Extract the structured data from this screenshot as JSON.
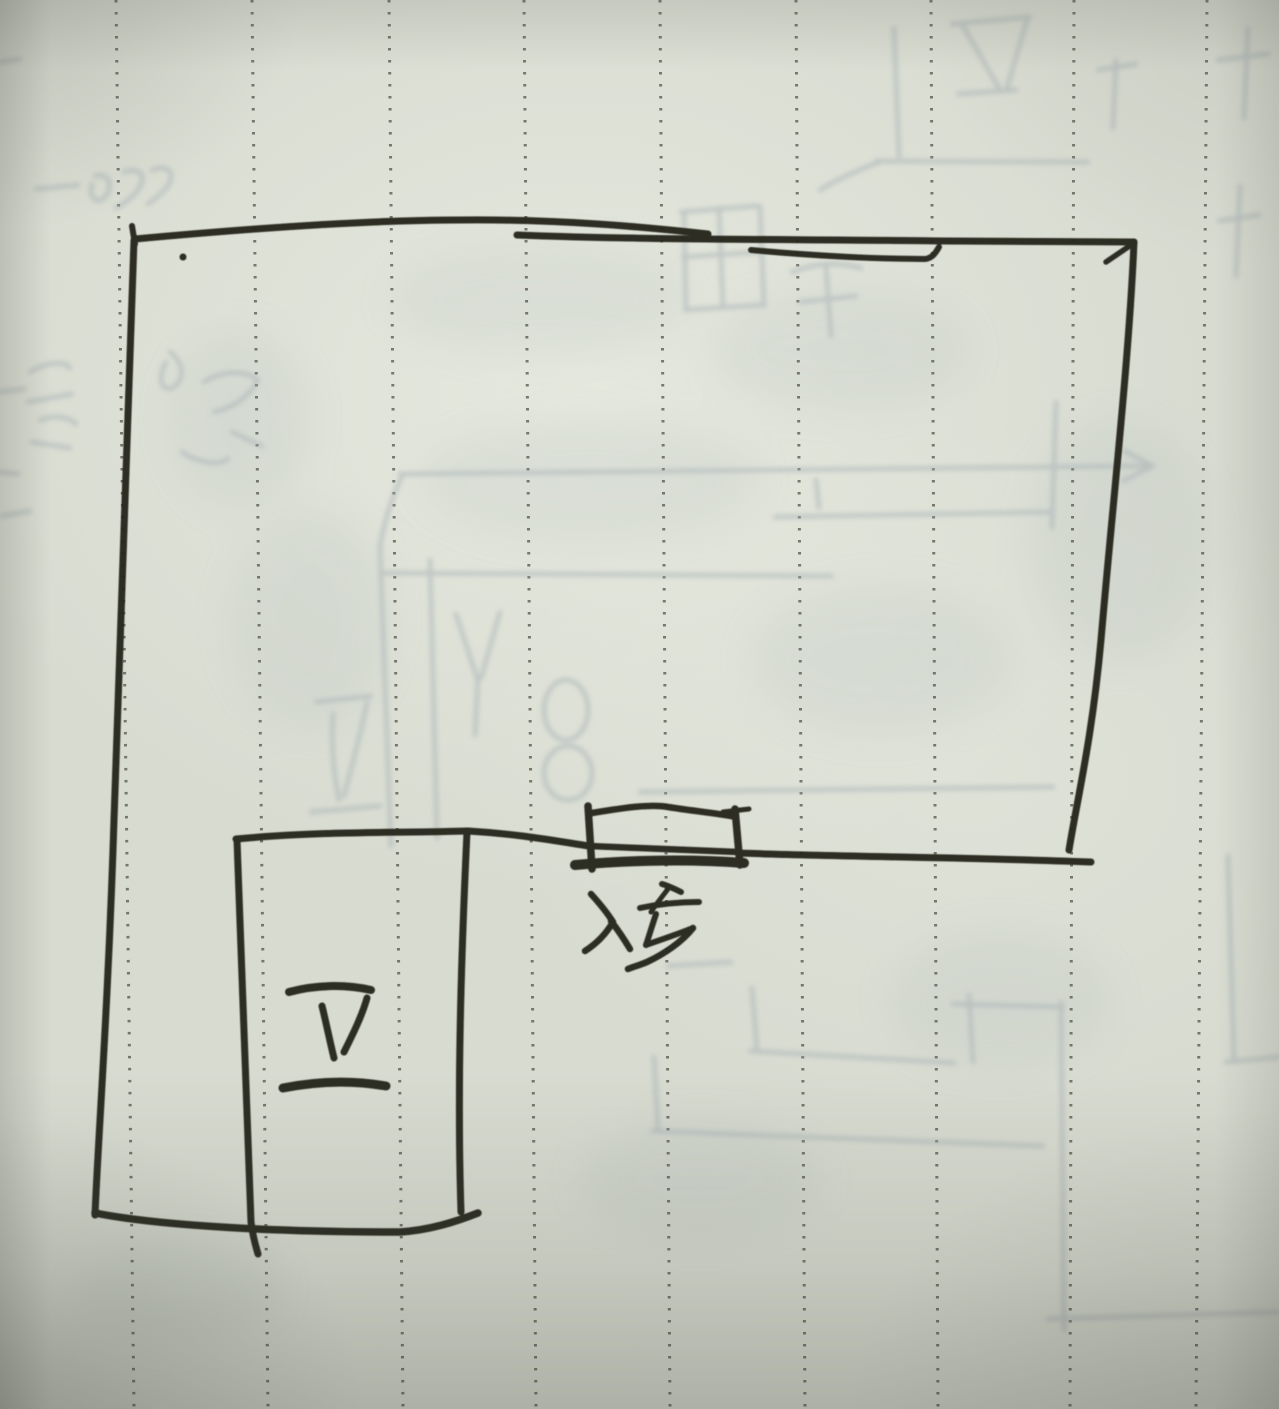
{
  "photo": {
    "kind": "hand-drawn floor plan sketch on dotted notebook paper",
    "paper": {
      "color": "#d7dbd0",
      "dotted_line_color": "#54534a",
      "dotted_line_count": 9
    },
    "ink_color": "#26251d",
    "pencil_ghost_color": "#a7b1b6",
    "labels": {
      "bathroom": {
        "text": "卫"
      },
      "entrance": {
        "text": "入户"
      }
    }
  }
}
